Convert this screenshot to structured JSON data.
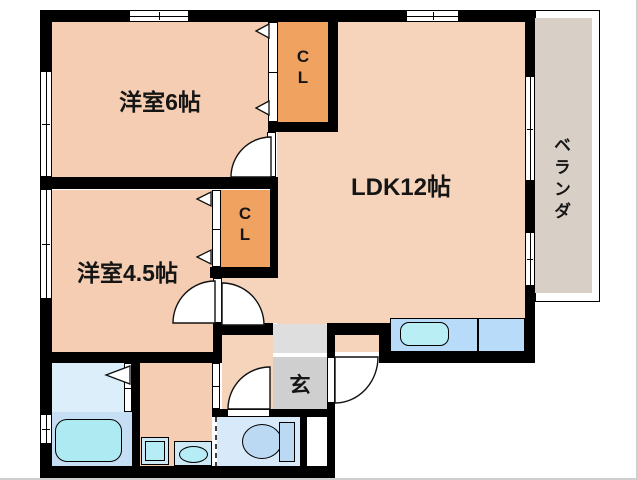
{
  "rooms": {
    "western6": {
      "label": "洋室6帖"
    },
    "western45": {
      "label": "洋室4.5帖"
    },
    "ldk": {
      "label": "LDK12帖"
    },
    "closet_top": {
      "label": "CL"
    },
    "closet_mid": {
      "label": "CL"
    },
    "entrance": {
      "label": "玄"
    },
    "veranda": {
      "label": "ベランダ"
    }
  },
  "colors": {
    "wall": "#000000",
    "room-floor": "#f4cdb2",
    "ldk-floor": "#f6d4bc",
    "closet": "#f0a261",
    "veranda": "#d8cfc7",
    "entrance-step": "#dedede",
    "entrance-floor": "#cfcfcf",
    "bath-floor": "#ddeefb",
    "bath-tub-area": "#c6def4",
    "tub": "#aeeaf2",
    "fixture-base": "#cde9f6",
    "fixture-basin": "#b5ecf5",
    "kitchen-counter": "#b7dbf8",
    "kitchen-sink": "#b9eef5",
    "toilet-floor": "#d8eaf9",
    "toilet-fixture": "#bcd9f4"
  }
}
